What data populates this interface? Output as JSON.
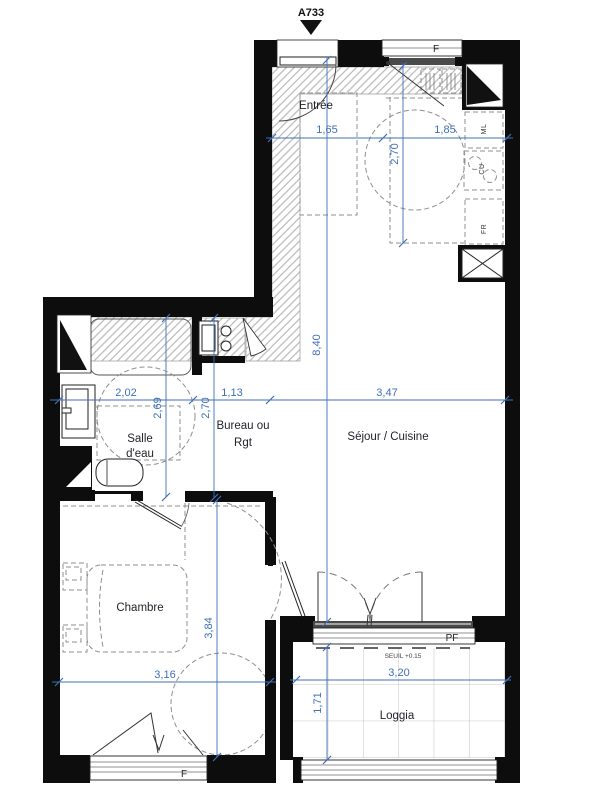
{
  "title_marker": "A733",
  "rooms": {
    "entree": "Entrée",
    "sejour": "Séjour / Cuisine",
    "salle_eau_line1": "Salle",
    "salle_eau_line2": "d'eau",
    "bureau_line1": "Bureau ou",
    "bureau_line2": "Rgt",
    "chambre": "Chambre",
    "loggia": "Loggia"
  },
  "openings": {
    "window_top": "F",
    "window_chambre": "F",
    "porte_fenetre": "PF",
    "threshold": "SEUIL +0.15"
  },
  "appliances": {
    "ml": "ML",
    "cu": "CU",
    "fr": "FR"
  },
  "dimensions": {
    "entree_width": "1,65",
    "cuisine_width": "1,85",
    "cuisine_depth": "2,70",
    "sejour_length": "8,40",
    "sejour_width": "3,47",
    "salle_eau_width": "2,02",
    "salle_eau_depth": "2,69",
    "bureau_width": "1,13",
    "bureau_depth": "2,70",
    "chambre_width": "3,16",
    "chambre_depth": "3,84",
    "loggia_width": "3,20",
    "loggia_depth": "1,71"
  },
  "colors": {
    "dimension_blue": "#3F6FB7",
    "wall_black": "#0D0D0D",
    "hatch_gray": "#ABABAB"
  }
}
